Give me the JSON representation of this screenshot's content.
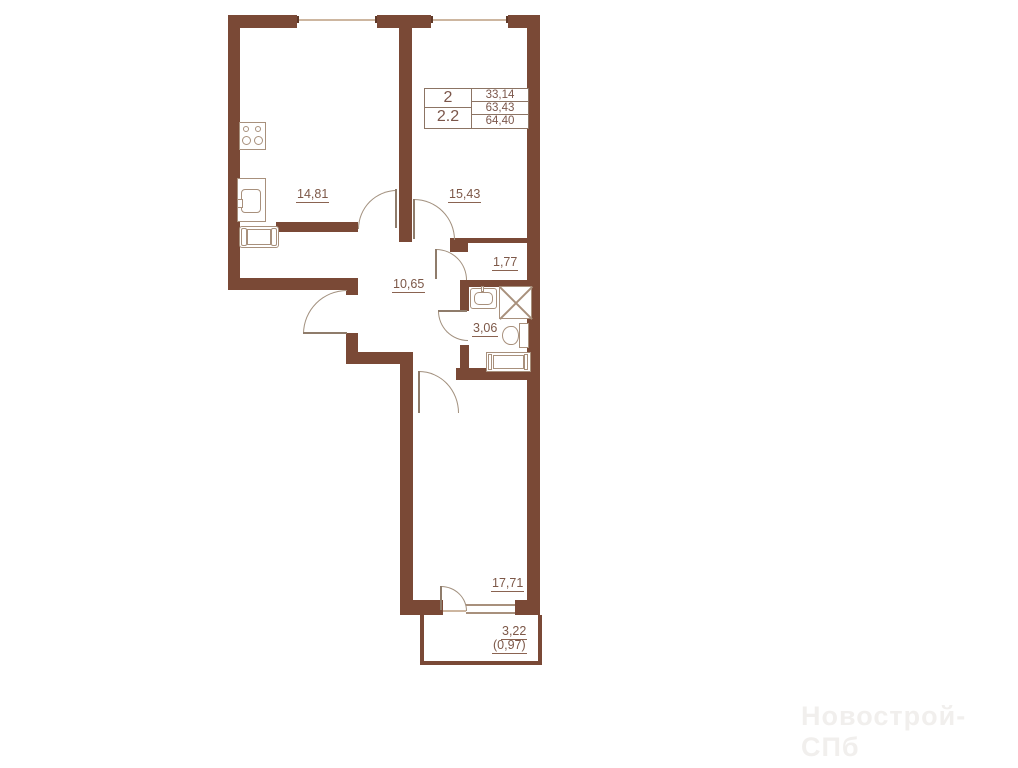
{
  "plan": {
    "info_table": {
      "left_rows": [
        "2",
        "2.2"
      ],
      "right_rows": [
        "33,14",
        "63,43",
        "64,40"
      ]
    },
    "rooms": {
      "kitchen_area": "14,81",
      "living_area": "15,43",
      "small_hall_area": "1,77",
      "corridor_area": "10,65",
      "bathroom_area": "3,06",
      "bedroom_area": "17,71",
      "balcony_area": "3,22",
      "balcony_reduced_area": "(0,97)"
    },
    "watermark": "Новострой-СПб",
    "colors": {
      "wall": "#7a4936",
      "fixture_outline": "#a8907c",
      "label_text": "#7d5848",
      "watermark": "#f1efed"
    }
  }
}
